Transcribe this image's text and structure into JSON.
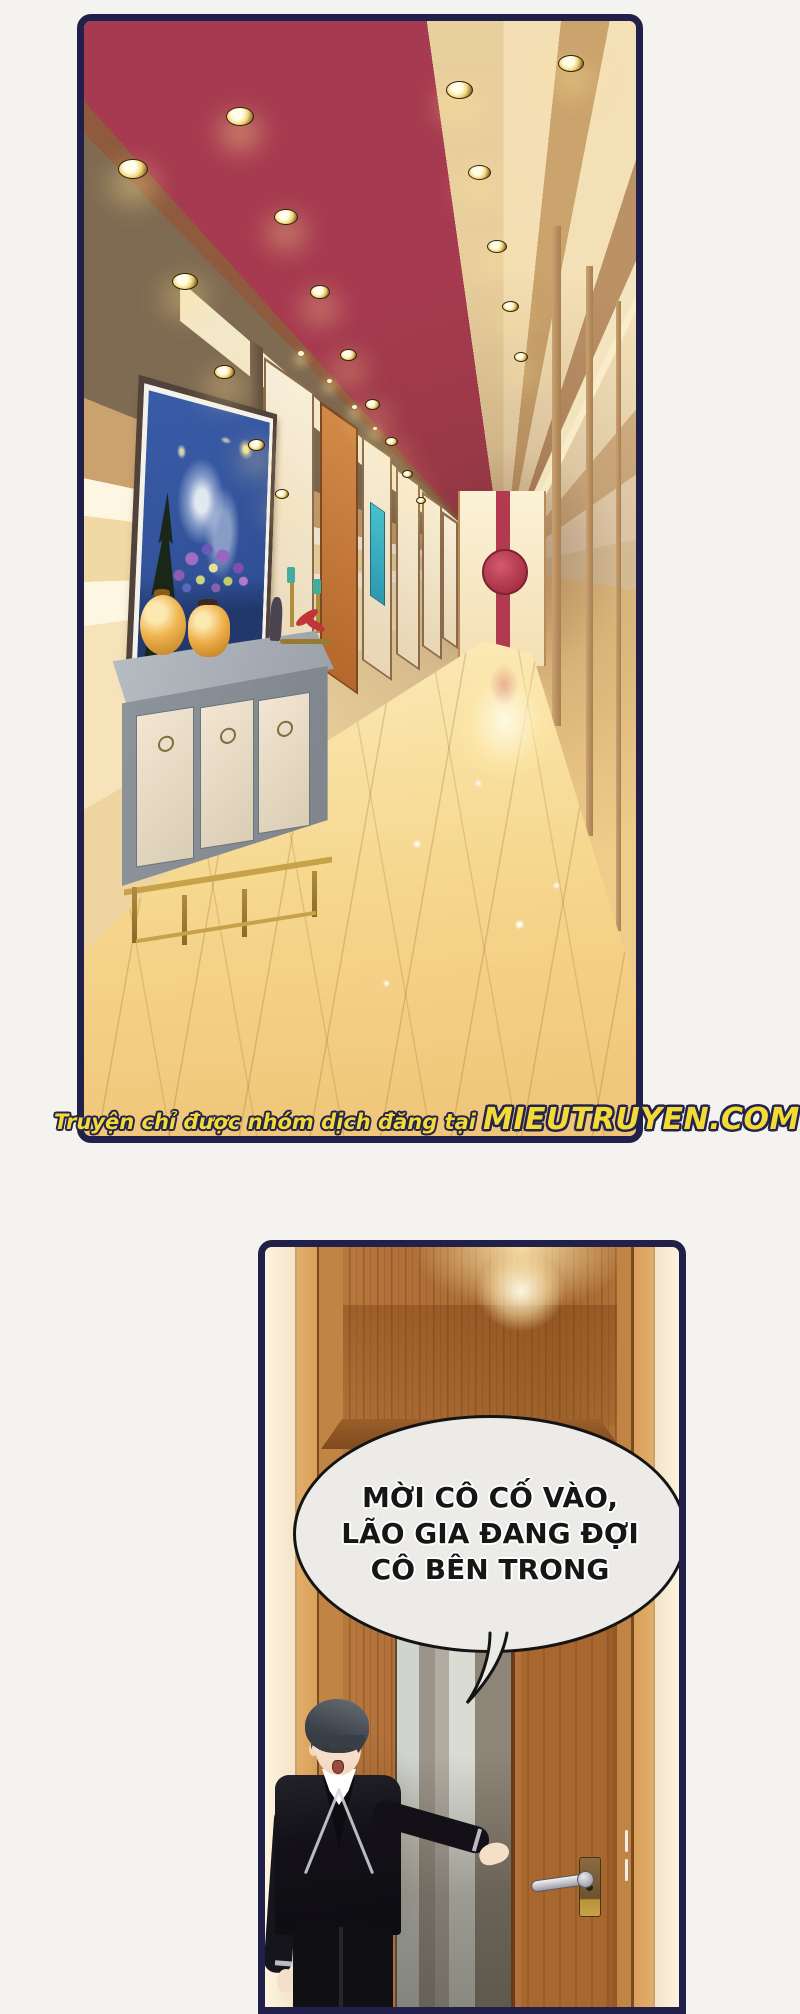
{
  "page": {
    "width": 800,
    "height": 2000,
    "background_color": "#f4f3f0",
    "panel_border_color": "#20204a"
  },
  "watermark": {
    "prefix": "Truyện chỉ được nhóm dịch đăng tại",
    "site": "MIEUTRUYEN.COM",
    "fill_color": "#f4da35",
    "outline_color": "#232350"
  },
  "panel1": {
    "label": "hallway-panel",
    "colors": {
      "ceiling_red": "#a63a50",
      "wall_cream": "#f3dfbd",
      "beam_dark_wood": "#7f6b52",
      "floor_gold": "#f5d38b",
      "end_medallion_red": "#b23a50",
      "sideboard_gray": "#8e949c",
      "sideboard_door_cream": "#f2e6d2",
      "sideboard_trim_gold": "#c8a24a",
      "vase_amber": "#f0b44f",
      "painting_blue": "#2e4e94",
      "painting_yellow": "#f2e493"
    }
  },
  "panel2": {
    "label": "door-panel",
    "speech_bubble": {
      "lines": [
        "MỜI CÔ CỐ VÀO,",
        "LÃO GIA ĐANG ĐỢI",
        "CÔ BÊN TRONG"
      ],
      "fill_color": "#edebe7",
      "border_color": "#141414"
    },
    "colors": {
      "door_wood": "#b2713a",
      "open_door_gray": "#8d8577",
      "wall_cream": "#f7ead3",
      "suit_black": "#131117",
      "skin": "#f6dfc8",
      "handle_silver": "#d8d8dc"
    }
  }
}
